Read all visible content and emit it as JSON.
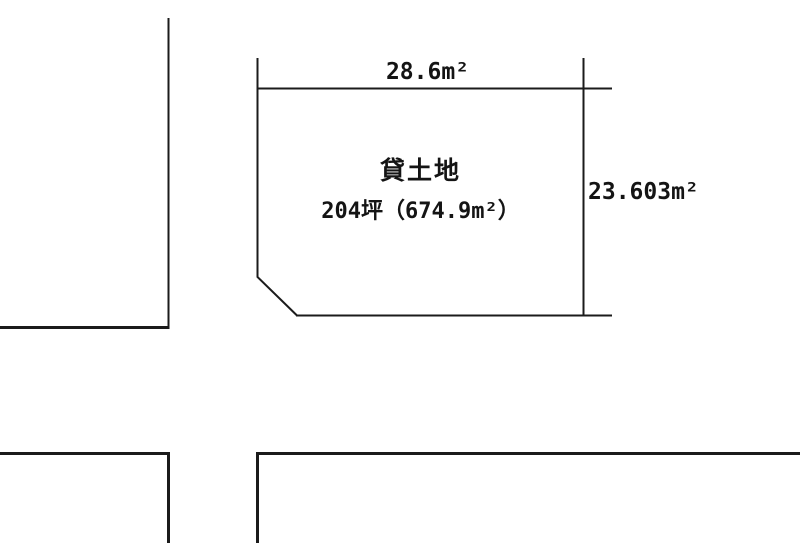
{
  "page": {
    "background_color": "#ffffff",
    "line_color": "#1b1b1b",
    "text_color": "#141414"
  },
  "plot": {
    "usage_label": "貸土地",
    "area_label": "204坪（674.9m²）",
    "top_dimension_label": "28.6m²",
    "right_dimension_label": "23.603m²"
  }
}
